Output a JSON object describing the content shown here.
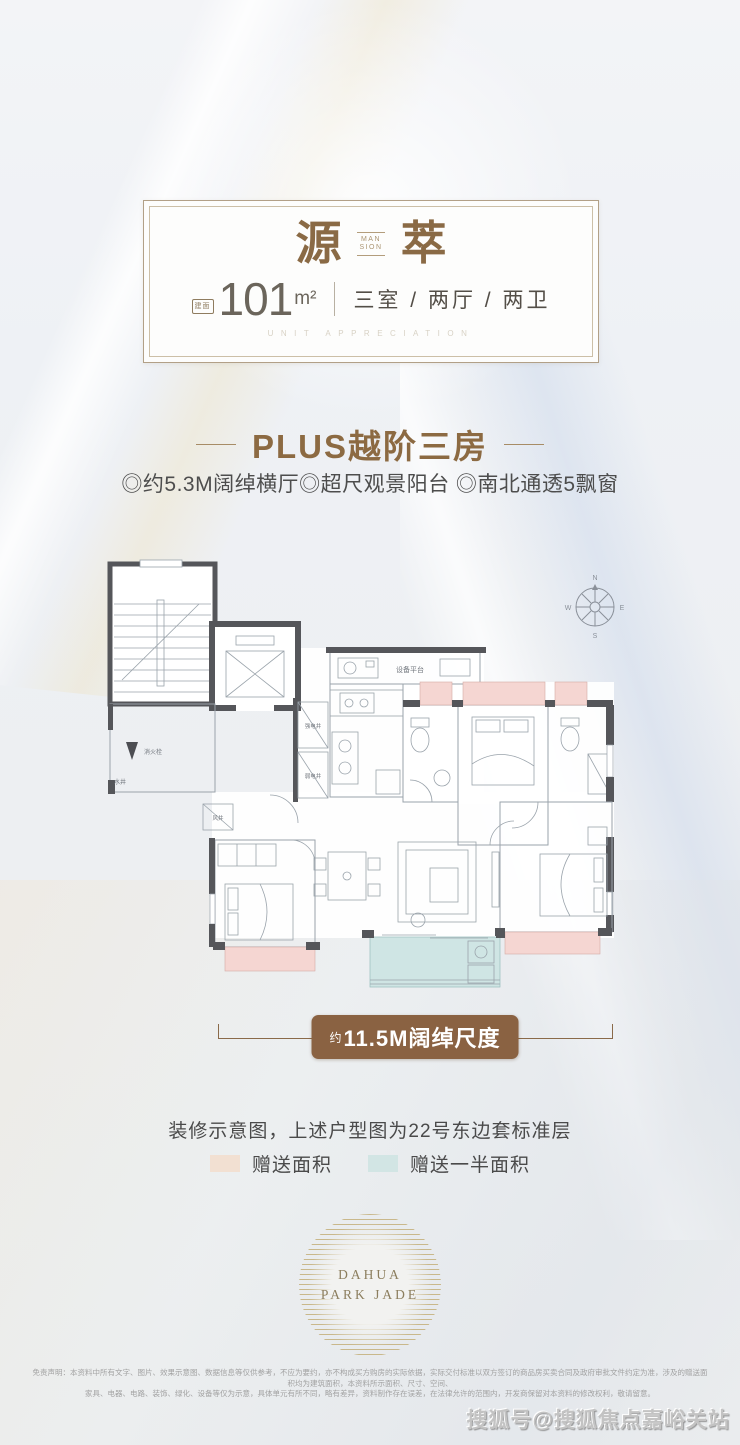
{
  "header": {
    "title_left": "源",
    "title_right": "萃",
    "title_mid_line1": "MAN",
    "title_mid_line2": "SION",
    "area_tag": "建面",
    "area_value": "101",
    "area_unit": "m²",
    "rooms_label": "三室 / 两厅 / 两卫",
    "subtitle_en": "UNIT APPRECIATION"
  },
  "section": {
    "heading": "PLUS越阶三房",
    "features": "◎约5.3M阔绰横厅◎超尺观景阳台 ◎南北通透5飘窗"
  },
  "floorplan": {
    "compass": {
      "n": "N",
      "e": "E",
      "s": "S",
      "w": "W"
    },
    "labels": {
      "equipment_platform": "设备平台",
      "strong_elec": "强电井",
      "weak_elec": "弱电井",
      "water_well": "水井",
      "fire_hydrant": "消火栓",
      "air_shaft": "风井"
    },
    "colors": {
      "wall": "#55565a",
      "line": "#9aa3ab",
      "gift_area": "#f5d6d2",
      "half_gift_area": "#cfe5e4"
    }
  },
  "dimension": {
    "prefix": "约",
    "label": "11.5M阔绰尺度",
    "badge_color": "#8a6242"
  },
  "caption": "装修示意图，上述户型图为22号东边套标准层",
  "legend": {
    "items": [
      {
        "label": "赠送面积",
        "color": "#f2e0d2"
      },
      {
        "label": "赠送一半面积",
        "color": "#d2e5e4"
      }
    ]
  },
  "logo": {
    "line1": "DAHUA",
    "line2": "PARK JADE"
  },
  "disclaimer": {
    "line1": "免责声明：本资料中所有文字、图片、效果示意图、数据信息等仅供参考，不应为要约，亦不构成买方购房的实际依据，实际交付标准以双方签订的商品房买卖合同及政府审批文件约定为准，涉及的赠送面积均为建筑面积，本资料所示面积、尺寸、空间、",
    "line2": "家具、电器、电路、装饰、绿化、设备等仅为示意，具体单元有所不同，略有差异，资料制作存在误差，在法律允许的范围内，开发商保留对本资料的修改权利，敬请留意。"
  },
  "watermark": "搜狐号@搜狐焦点嘉峪关站"
}
